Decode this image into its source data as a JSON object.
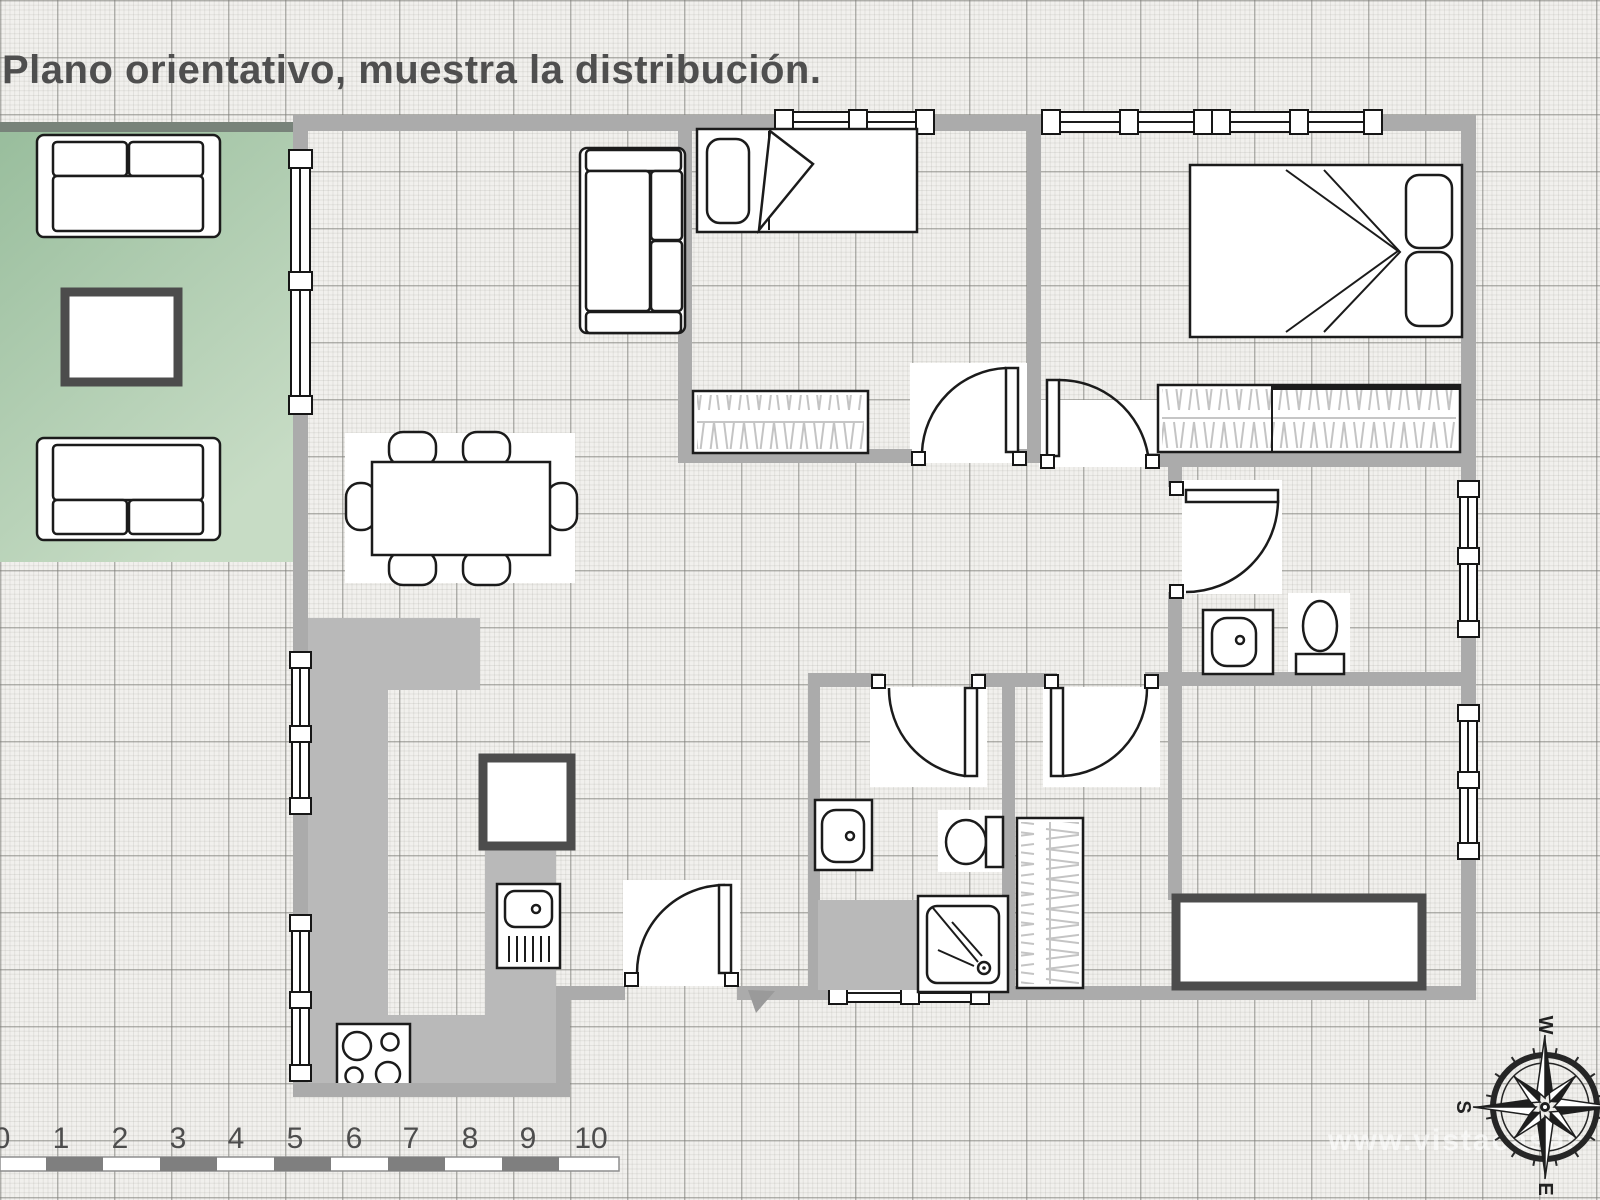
{
  "title": "Plano orientativo, muestra la distribución.",
  "watermark": "www.vistacasas",
  "scale_bar": {
    "labels": [
      "0",
      "1",
      "2",
      "3",
      "4",
      "5",
      "6",
      "7",
      "8",
      "9",
      "10"
    ]
  },
  "compass": {
    "west": "W",
    "south": "S",
    "east": "E"
  },
  "colors": {
    "wall_gray": "#ababab",
    "terrace_green_dark": "#9cc09f",
    "terrace_green_light": "#c6dcc4",
    "counter_gray": "#b9b9b9",
    "paper": "#f1f0ed",
    "text_gray": "#4f4f4f"
  }
}
